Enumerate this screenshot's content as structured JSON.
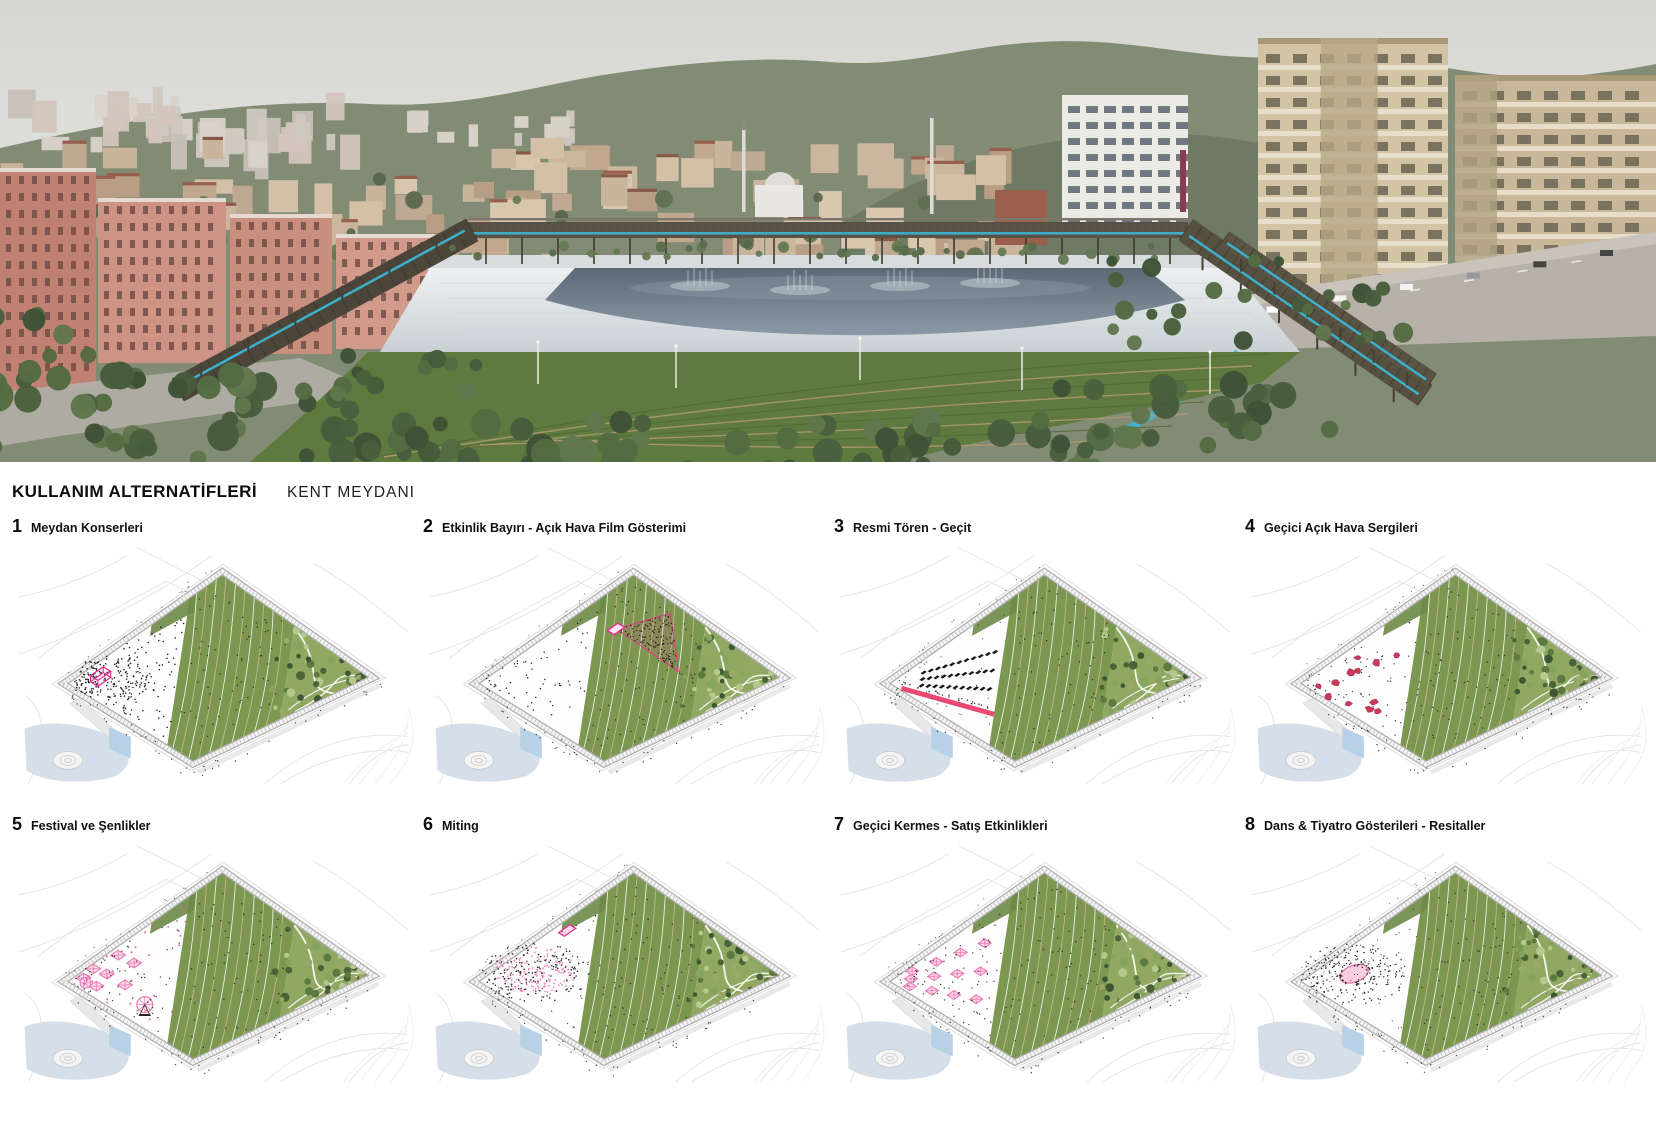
{
  "header": {
    "title": "KULLANIM ALTERNATİFLERİ",
    "subtitle": "KENT MEYDANI"
  },
  "scenarios": [
    {
      "num": "1",
      "label": "Meydan Konserleri",
      "overlay": "crowd"
    },
    {
      "num": "2",
      "label": "Etkinlik Bayırı - Açık Hava Film Gösterimi",
      "overlay": "screen"
    },
    {
      "num": "3",
      "label": "Resmi Tören - Geçit",
      "overlay": "parade"
    },
    {
      "num": "4",
      "label": "Geçici Açık Hava Sergileri",
      "overlay": "sculpture"
    },
    {
      "num": "5",
      "label": "Festival ve Şenlikler",
      "overlay": "festival"
    },
    {
      "num": "6",
      "label": "Miting",
      "overlay": "rally"
    },
    {
      "num": "7",
      "label": "Geçici Kermes - Satış Etkinlikleri",
      "overlay": "tents"
    },
    {
      "num": "8",
      "label": "Dans & Tiyatro Gösterileri - Resitaller",
      "overlay": "stage"
    }
  ],
  "palette": {
    "accent_pink": "#ec2f92",
    "parade_pink": "#e84a72",
    "sculpture_red": "#c93a5a",
    "festival_pink": "#ee7ab4",
    "festival_fill": "#fbd9ea",
    "stage_fill": "#f7cde0",
    "stage_stroke": "#e674aa",
    "crowd_black": "#141414",
    "lawn_green": "#7b9750",
    "park_green": "#90a861",
    "terrace_tan": "#c9b88f",
    "tree_dark": "#3d5733",
    "pond_blue": "#cfdce8",
    "water_cyan": "#3cb6d4",
    "pergola_brown": "#52493c"
  }
}
